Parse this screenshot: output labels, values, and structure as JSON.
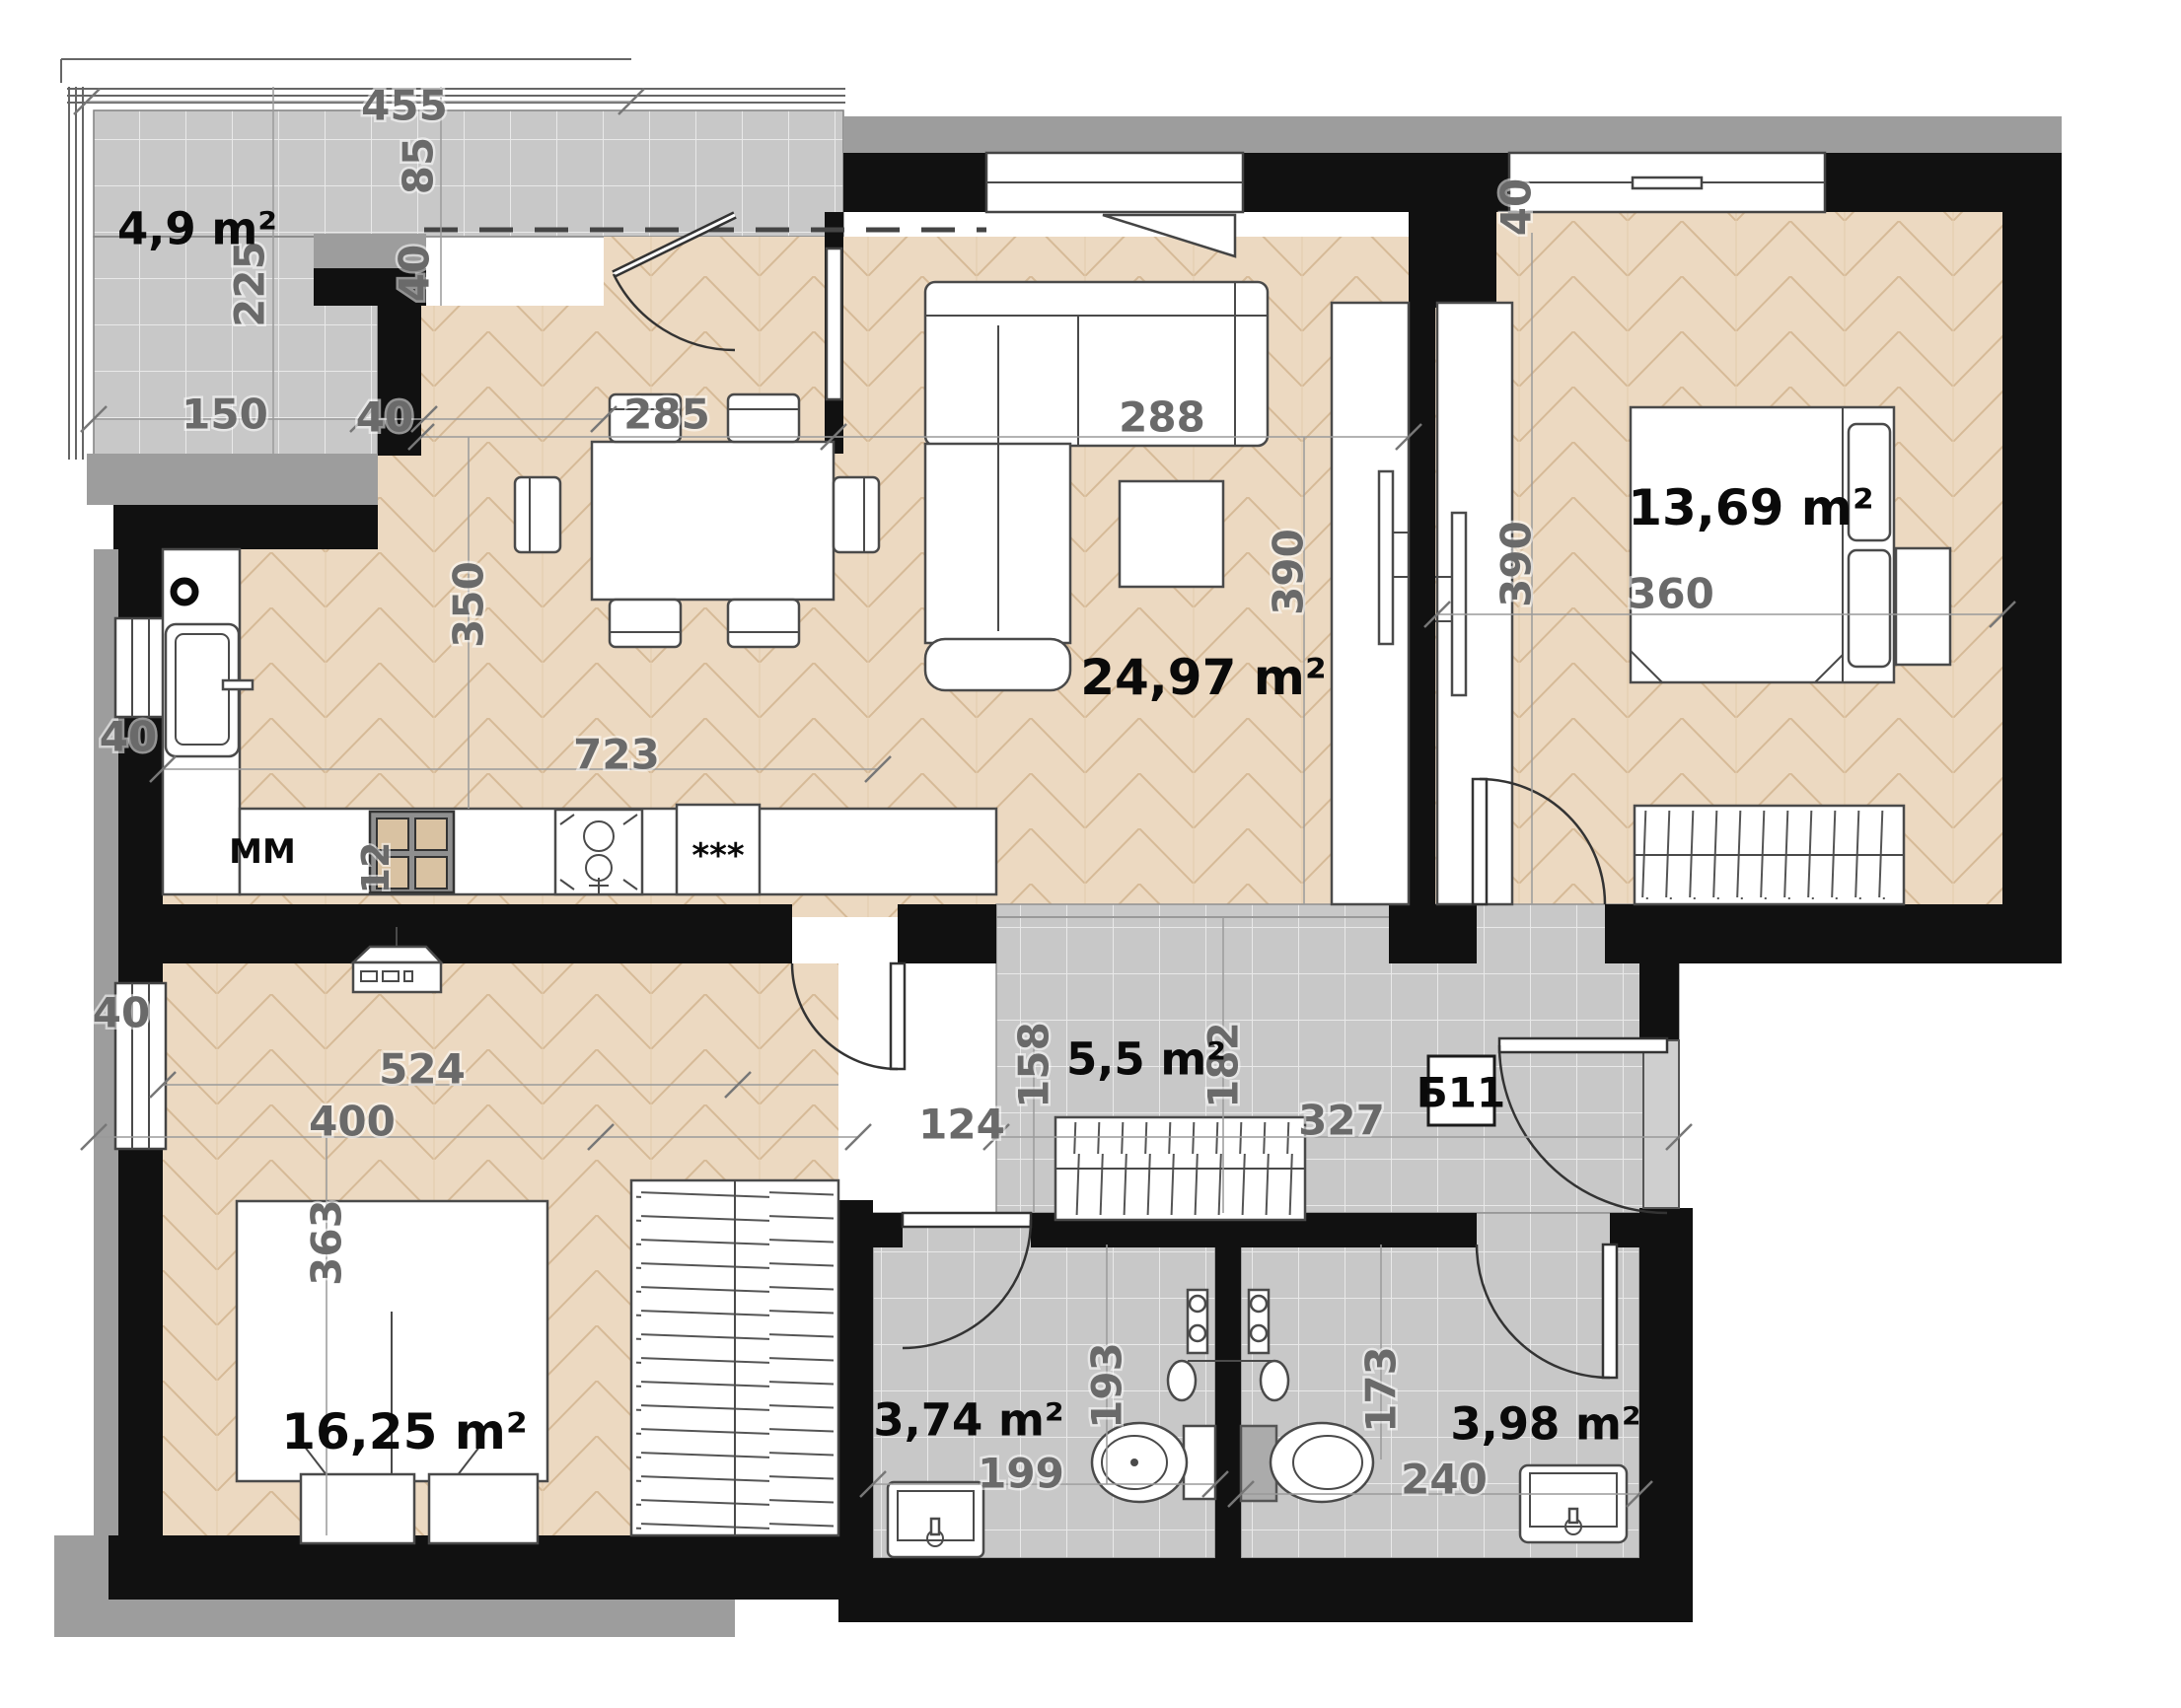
{
  "unit": {
    "label": "Б11"
  },
  "rooms": [
    {
      "id": "terrace",
      "area": "4,9 m²"
    },
    {
      "id": "living-kitchen",
      "area": "24,97 m²"
    },
    {
      "id": "bedroom-1",
      "area": "13,69 m²"
    },
    {
      "id": "hallway",
      "area": "5,5 m²"
    },
    {
      "id": "bedroom-2",
      "area": "16,25 m²"
    },
    {
      "id": "bathroom-1",
      "area": "3,74 m²"
    },
    {
      "id": "bathroom-2",
      "area": "3,98 m²"
    }
  ],
  "appliance_labels": {
    "microwave": "MM",
    "freezer_stars": "***"
  },
  "dimensions": {
    "d455": "455",
    "d85": "85",
    "d225": "225",
    "d150": "150",
    "d40_terrace_door": "40",
    "d40_terrace_bottom": "40",
    "d285": "285",
    "d350": "350",
    "d288": "288",
    "d390_living": "390",
    "d390_bedroom1": "390",
    "d40_bedroom1_top": "40",
    "d360": "360",
    "d723": "723",
    "d12": "12",
    "d40_kitchen_window": "40",
    "d40_bedroom2_window": "40",
    "d524": "524",
    "d400": "400",
    "d363": "363",
    "d124": "124",
    "d158": "158",
    "d182": "182",
    "d327": "327",
    "d193": "193",
    "d199": "199",
    "d173": "173",
    "d240": "240"
  }
}
